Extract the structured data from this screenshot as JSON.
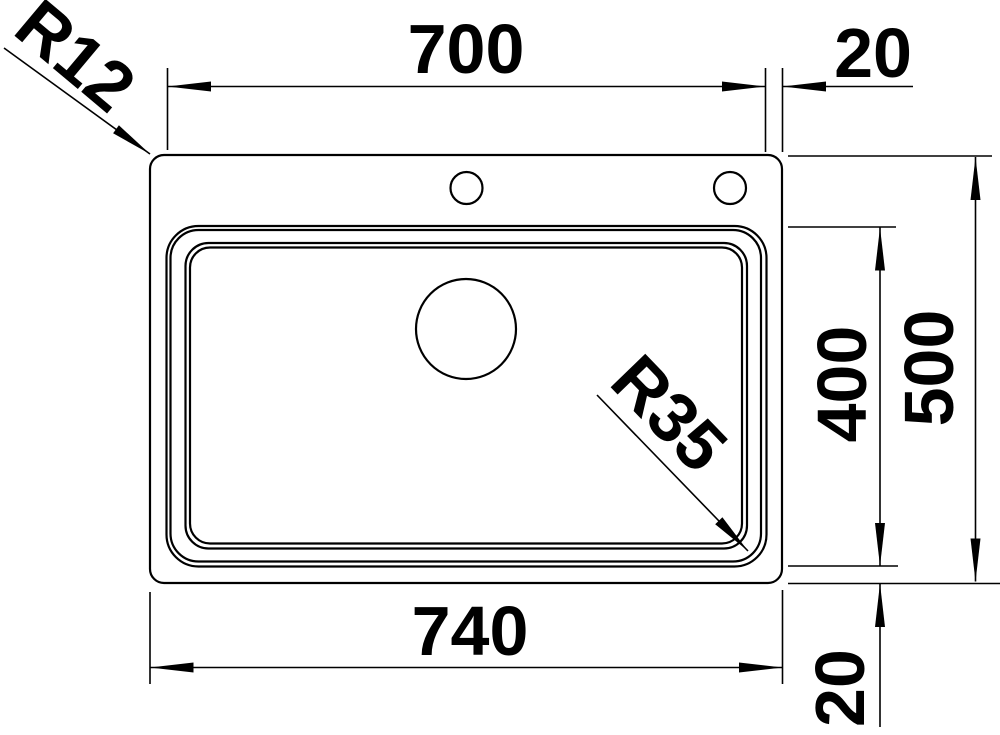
{
  "drawing": {
    "kind": "sink-plan-technical-drawing",
    "background_color": "#ffffff",
    "line_color": "#000000",
    "labels": {
      "dim_bowl_width": "700",
      "dim_rim_offset_right": "20",
      "dim_overall_width": "740",
      "dim_bowl_depth": "400",
      "dim_overall_depth": "500",
      "dim_rim_offset_bottom": "20",
      "radius_outer_corner": "R12",
      "radius_bowl_corner": "R35"
    }
  }
}
